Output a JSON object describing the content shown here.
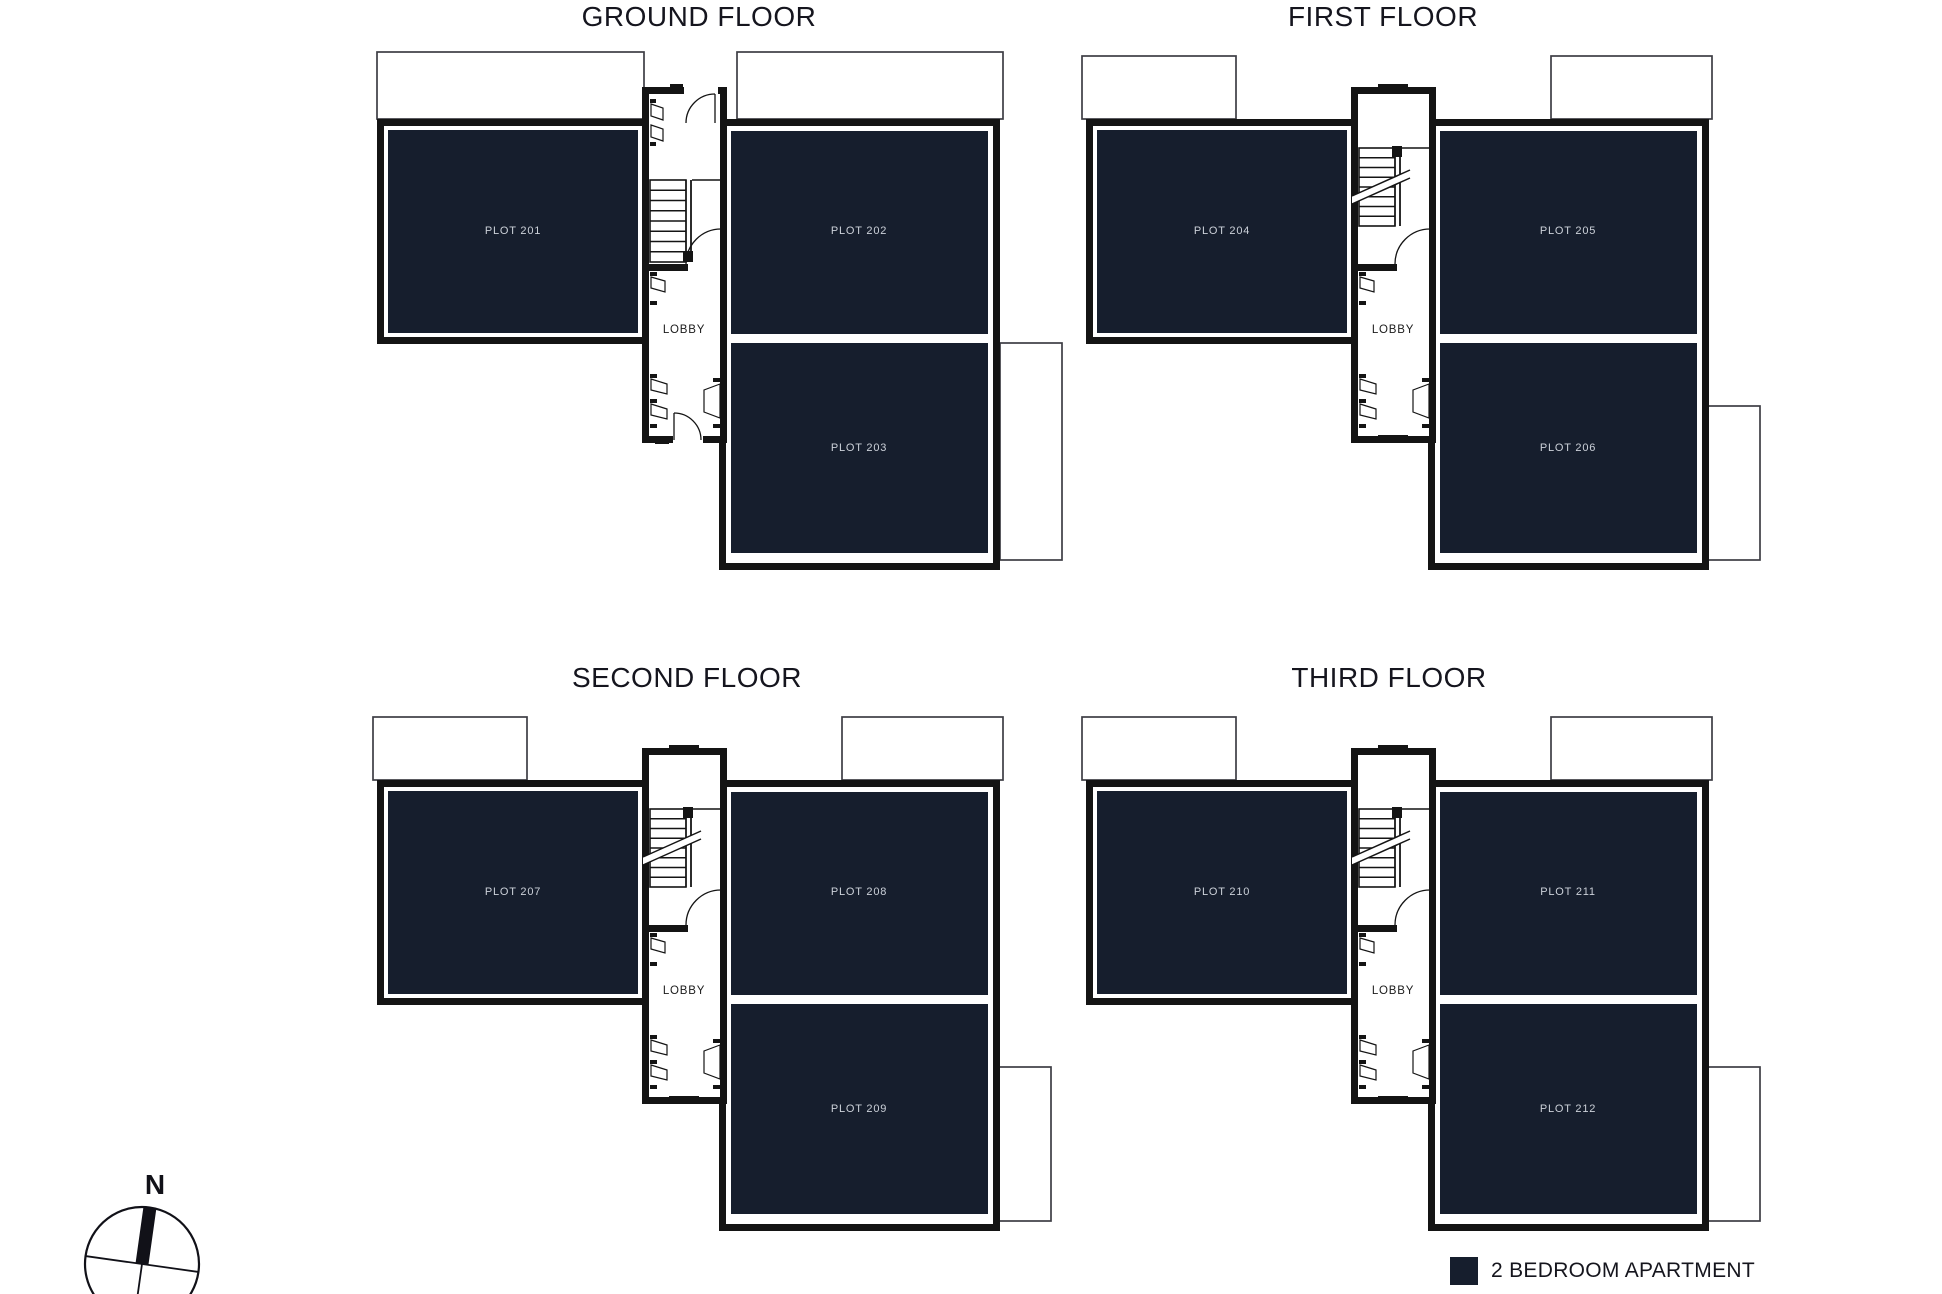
{
  "floors": [
    {
      "title": "GROUND FLOOR",
      "lobby": "LOBBY",
      "plots": [
        {
          "label": "PLOT 201"
        },
        {
          "label": "PLOT 202"
        },
        {
          "label": "PLOT 203"
        }
      ]
    },
    {
      "title": "FIRST FLOOR",
      "lobby": "LOBBY",
      "plots": [
        {
          "label": "PLOT 204"
        },
        {
          "label": "PLOT 205"
        },
        {
          "label": "PLOT 206"
        }
      ]
    },
    {
      "title": "SECOND FLOOR",
      "lobby": "LOBBY",
      "plots": [
        {
          "label": "PLOT 207"
        },
        {
          "label": "PLOT 208"
        },
        {
          "label": "PLOT 209"
        }
      ]
    },
    {
      "title": "THIRD FLOOR",
      "lobby": "LOBBY",
      "plots": [
        {
          "label": "PLOT 210"
        },
        {
          "label": "PLOT 211"
        },
        {
          "label": "PLOT 212"
        }
      ]
    }
  ],
  "legend": {
    "label": "2 BEDROOM APARTMENT",
    "swatch_color": "#161e2d"
  },
  "compass": {
    "label": "N"
  },
  "colors": {
    "apartment_fill": "#161e2d",
    "wall": "#141414",
    "outline": "#3d3d44",
    "plot_text": "#ccd1d9",
    "title_text": "#15151e"
  }
}
